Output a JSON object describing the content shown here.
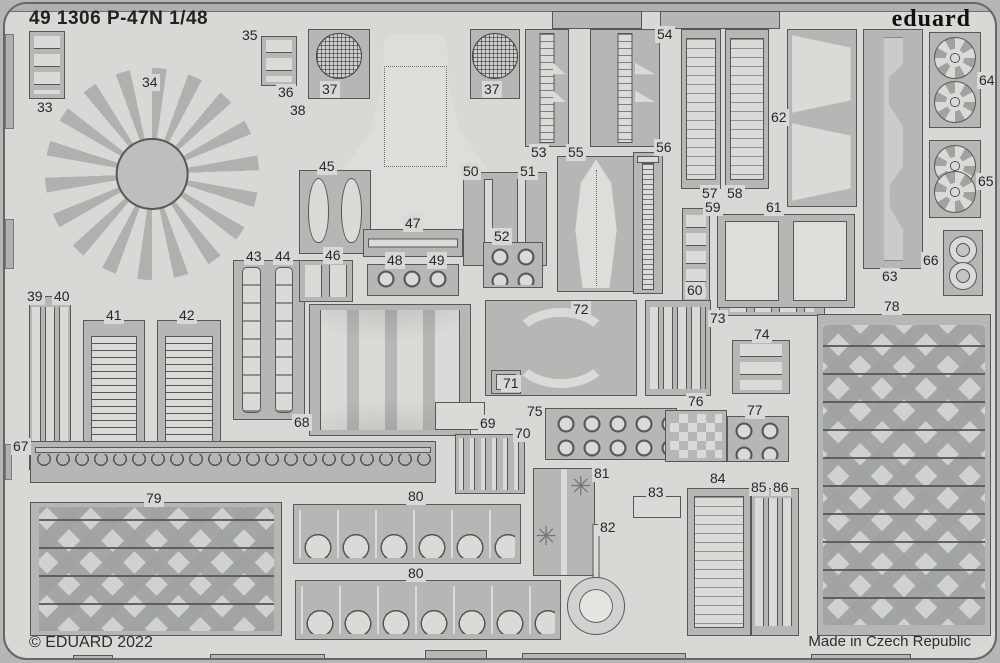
{
  "sheet": {
    "title": "49 1306 P-47N 1/48",
    "brand": "eduard",
    "copyright": "© EDUARD 2022",
    "made_in": "Made in Czech Republic",
    "colors": {
      "sheet_bg": "#d7d9d4",
      "panel_fill": "#b4b7b3",
      "part_fill": "#d9dbd6",
      "outline": "#55585b",
      "text": "#26282a"
    }
  },
  "part_numbers": [
    {
      "text": "33",
      "x": 30,
      "y": 95
    },
    {
      "text": "34",
      "x": 135,
      "y": 70
    },
    {
      "text": "35",
      "x": 235,
      "y": 23
    },
    {
      "text": "36",
      "x": 271,
      "y": 80
    },
    {
      "text": "37",
      "x": 315,
      "y": 77
    },
    {
      "text": "37",
      "x": 477,
      "y": 77
    },
    {
      "text": "38",
      "x": 283,
      "y": 98
    },
    {
      "text": "39",
      "x": 20,
      "y": 284
    },
    {
      "text": "40",
      "x": 47,
      "y": 284
    },
    {
      "text": "41",
      "x": 99,
      "y": 303
    },
    {
      "text": "42",
      "x": 172,
      "y": 303
    },
    {
      "text": "43",
      "x": 239,
      "y": 244
    },
    {
      "text": "44",
      "x": 268,
      "y": 244
    },
    {
      "text": "45",
      "x": 312,
      "y": 154
    },
    {
      "text": "46",
      "x": 318,
      "y": 243
    },
    {
      "text": "47",
      "x": 398,
      "y": 211
    },
    {
      "text": "48",
      "x": 380,
      "y": 248
    },
    {
      "text": "49",
      "x": 422,
      "y": 248
    },
    {
      "text": "50",
      "x": 456,
      "y": 159
    },
    {
      "text": "51",
      "x": 513,
      "y": 159
    },
    {
      "text": "52",
      "x": 487,
      "y": 224
    },
    {
      "text": "53",
      "x": 524,
      "y": 140
    },
    {
      "text": "54",
      "x": 650,
      "y": 22
    },
    {
      "text": "55",
      "x": 561,
      "y": 140
    },
    {
      "text": "56",
      "x": 649,
      "y": 135
    },
    {
      "text": "57",
      "x": 695,
      "y": 181
    },
    {
      "text": "58",
      "x": 720,
      "y": 181
    },
    {
      "text": "59",
      "x": 698,
      "y": 195
    },
    {
      "text": "60",
      "x": 680,
      "y": 278
    },
    {
      "text": "61",
      "x": 759,
      "y": 195
    },
    {
      "text": "62",
      "x": 764,
      "y": 105
    },
    {
      "text": "63",
      "x": 875,
      "y": 264
    },
    {
      "text": "64",
      "x": 972,
      "y": 68
    },
    {
      "text": "65",
      "x": 971,
      "y": 169
    },
    {
      "text": "66",
      "x": 916,
      "y": 248
    },
    {
      "text": "67",
      "x": 6,
      "y": 434
    },
    {
      "text": "68",
      "x": 287,
      "y": 410
    },
    {
      "text": "69",
      "x": 473,
      "y": 411
    },
    {
      "text": "70",
      "x": 508,
      "y": 421
    },
    {
      "text": "71",
      "x": 496,
      "y": 371
    },
    {
      "text": "72",
      "x": 566,
      "y": 297
    },
    {
      "text": "73",
      "x": 703,
      "y": 306
    },
    {
      "text": "74",
      "x": 747,
      "y": 322
    },
    {
      "text": "75",
      "x": 520,
      "y": 399
    },
    {
      "text": "76",
      "x": 681,
      "y": 389
    },
    {
      "text": "77",
      "x": 740,
      "y": 398
    },
    {
      "text": "78",
      "x": 877,
      "y": 294
    },
    {
      "text": "79",
      "x": 139,
      "y": 486
    },
    {
      "text": "80",
      "x": 401,
      "y": 484
    },
    {
      "text": "80",
      "x": 401,
      "y": 561
    },
    {
      "text": "81",
      "x": 587,
      "y": 461
    },
    {
      "text": "82",
      "x": 593,
      "y": 515
    },
    {
      "text": "83",
      "x": 641,
      "y": 480
    },
    {
      "text": "84",
      "x": 703,
      "y": 466
    },
    {
      "text": "85",
      "x": 744,
      "y": 475
    },
    {
      "text": "86",
      "x": 766,
      "y": 475
    }
  ],
  "panels": [
    {
      "part": "33",
      "kind": "clamps",
      "x": 24,
      "y": 27,
      "w": 36,
      "h": 68
    },
    {
      "part": "34",
      "kind": "fan",
      "x": 40,
      "y": 64,
      "w": 214,
      "h": 212
    },
    {
      "part": "35-36",
      "kind": "clamps",
      "x": 256,
      "y": 32,
      "w": 36,
      "h": 50
    },
    {
      "part": "38",
      "kind": "cowl",
      "x": 318,
      "y": 30,
      "w": 185,
      "h": 202
    },
    {
      "part": "37",
      "kind": "mesh1",
      "x": 303,
      "y": 25,
      "w": 62,
      "h": 70
    },
    {
      "part": "37",
      "kind": "mesh1",
      "x": 465,
      "y": 25,
      "w": 50,
      "h": 70
    },
    {
      "part": "39-40",
      "kind": "vstrips",
      "x": 24,
      "y": 292,
      "w": 42,
      "h": 174
    },
    {
      "part": "41",
      "kind": "louvers",
      "x": 78,
      "y": 316,
      "w": 62,
      "h": 150
    },
    {
      "part": "42",
      "kind": "louvers",
      "x": 152,
      "y": 316,
      "w": 64,
      "h": 150
    },
    {
      "part": "43-44",
      "kind": "belts2",
      "x": 228,
      "y": 256,
      "w": 72,
      "h": 160
    },
    {
      "part": "45",
      "kind": "teardrops2",
      "x": 294,
      "y": 166,
      "w": 72,
      "h": 84
    },
    {
      "part": "46",
      "kind": "squares",
      "x": 294,
      "y": 256,
      "w": 54,
      "h": 42
    },
    {
      "part": "47",
      "kind": "rodH",
      "x": 358,
      "y": 225,
      "w": 100,
      "h": 28
    },
    {
      "part": "48-49",
      "kind": "dots",
      "x": 362,
      "y": 260,
      "w": 92,
      "h": 32
    },
    {
      "part": "50-51",
      "kind": "bars",
      "x": 458,
      "y": 168,
      "w": 84,
      "h": 94
    },
    {
      "part": "52",
      "kind": "dots",
      "x": 478,
      "y": 238,
      "w": 60,
      "h": 46
    },
    {
      "part": "53",
      "kind": "flapstrip",
      "x": 520,
      "y": 25,
      "w": 44,
      "h": 118
    },
    {
      "part": "54",
      "kind": "flapstrip",
      "x": 585,
      "y": 25,
      "w": 70,
      "h": 118
    },
    {
      "part": "55",
      "kind": "fin",
      "x": 552,
      "y": 152,
      "w": 78,
      "h": 136
    },
    {
      "part": "56",
      "kind": "ladder",
      "x": 628,
      "y": 148,
      "w": 30,
      "h": 142
    },
    {
      "part": "57",
      "kind": "radiator",
      "x": 676,
      "y": 25,
      "w": 40,
      "h": 160
    },
    {
      "part": "58",
      "kind": "radiator",
      "x": 720,
      "y": 25,
      "w": 44,
      "h": 160
    },
    {
      "part": "59",
      "kind": "clamps",
      "x": 677,
      "y": 204,
      "w": 28,
      "h": 96
    },
    {
      "part": "60",
      "kind": "squares",
      "x": 714,
      "y": 284,
      "w": 106,
      "h": 28
    },
    {
      "part": "61",
      "kind": "tanks2",
      "x": 712,
      "y": 210,
      "w": 138,
      "h": 94
    },
    {
      "part": "62",
      "kind": "funnels",
      "x": 782,
      "y": 25,
      "w": 70,
      "h": 178
    },
    {
      "part": "63",
      "kind": "scurve",
      "x": 858,
      "y": 25,
      "w": 60,
      "h": 240
    },
    {
      "part": "64",
      "kind": "wheels2",
      "x": 924,
      "y": 28,
      "w": 52,
      "h": 96
    },
    {
      "part": "65",
      "kind": "wheels2",
      "x": 924,
      "y": 136,
      "w": 52,
      "h": 78
    },
    {
      "part": "66",
      "kind": "discs2",
      "x": 938,
      "y": 226,
      "w": 40,
      "h": 66
    },
    {
      "part": "67",
      "kind": "hookrow",
      "x": 25,
      "y": 437,
      "w": 406,
      "h": 42
    },
    {
      "part": "68",
      "kind": "straps",
      "x": 304,
      "y": 300,
      "w": 162,
      "h": 132
    },
    {
      "part": "69",
      "kind": "light",
      "x": 430,
      "y": 398,
      "w": 50,
      "h": 28
    },
    {
      "part": "70",
      "kind": "pins",
      "x": 450,
      "y": 430,
      "w": 70,
      "h": 60
    },
    {
      "part": "71-72",
      "kind": "arcs",
      "x": 480,
      "y": 296,
      "w": 152,
      "h": 96
    },
    {
      "part": "71",
      "kind": "plain",
      "x": 486,
      "y": 366,
      "w": 30,
      "h": 24
    },
    {
      "part": "73",
      "kind": "vstrips",
      "x": 640,
      "y": 296,
      "w": 66,
      "h": 96
    },
    {
      "part": "74",
      "kind": "clamps",
      "x": 727,
      "y": 336,
      "w": 58,
      "h": 54
    },
    {
      "part": "75",
      "kind": "dots",
      "x": 540,
      "y": 404,
      "w": 132,
      "h": 52
    },
    {
      "part": "76",
      "kind": "checker",
      "x": 660,
      "y": 406,
      "w": 62,
      "h": 52
    },
    {
      "part": "77",
      "kind": "dots",
      "x": 722,
      "y": 412,
      "w": 62,
      "h": 46
    },
    {
      "part": "78",
      "kind": "chevrons",
      "x": 812,
      "y": 310,
      "w": 174,
      "h": 322
    },
    {
      "part": "79",
      "kind": "chevrons",
      "x": 25,
      "y": 498,
      "w": 252,
      "h": 134
    },
    {
      "part": "80",
      "kind": "uhooks",
      "x": 288,
      "y": 500,
      "w": 228,
      "h": 60
    },
    {
      "part": "80",
      "kind": "uhooks",
      "x": 290,
      "y": 576,
      "w": 266,
      "h": 60
    },
    {
      "part": "81",
      "kind": "starstrip",
      "x": 528,
      "y": 464,
      "w": 62,
      "h": 108
    },
    {
      "part": "82",
      "kind": "ringpart",
      "x": 560,
      "y": 520,
      "w": 62,
      "h": 112
    },
    {
      "part": "83",
      "kind": "light",
      "x": 628,
      "y": 492,
      "w": 48,
      "h": 22
    },
    {
      "part": "84",
      "kind": "radiator",
      "x": 682,
      "y": 484,
      "w": 64,
      "h": 148
    },
    {
      "part": "85-86",
      "kind": "vstrips",
      "x": 746,
      "y": 484,
      "w": 48,
      "h": 148
    },
    {
      "part": "frame-tab",
      "kind": "bare",
      "x": 547,
      "y": 7,
      "w": 90,
      "h": 18
    },
    {
      "part": "frame-tab",
      "kind": "bare",
      "x": 655,
      "y": 7,
      "w": 120,
      "h": 18
    },
    {
      "part": "frame-tab",
      "kind": "bare",
      "x": 68,
      "y": 651,
      "w": 40,
      "h": 9
    },
    {
      "part": "frame-tab",
      "kind": "bare",
      "x": 205,
      "y": 650,
      "w": 115,
      "h": 10
    },
    {
      "part": "frame-tab",
      "kind": "bare",
      "x": 420,
      "y": 646,
      "w": 62,
      "h": 14
    },
    {
      "part": "frame-tab",
      "kind": "bare",
      "x": 517,
      "y": 649,
      "w": 164,
      "h": 11
    },
    {
      "part": "frame-tab",
      "kind": "bare",
      "x": 806,
      "y": 650,
      "w": 100,
      "h": 10
    },
    {
      "part": "frame-edge",
      "kind": "edge",
      "x": 0,
      "y": 30,
      "w": 9,
      "h": 95
    },
    {
      "part": "frame-edge",
      "kind": "edge",
      "x": 0,
      "y": 215,
      "w": 9,
      "h": 50
    },
    {
      "part": "frame-edge",
      "kind": "edge",
      "x": 0,
      "y": 440,
      "w": 7,
      "h": 36
    },
    {
      "part": "frame-edge",
      "kind": "edge",
      "x": 993,
      "y": 90,
      "w": 7,
      "h": 120
    },
    {
      "part": "frame-edge",
      "kind": "edge",
      "x": 993,
      "y": 520,
      "w": 7,
      "h": 60
    }
  ]
}
